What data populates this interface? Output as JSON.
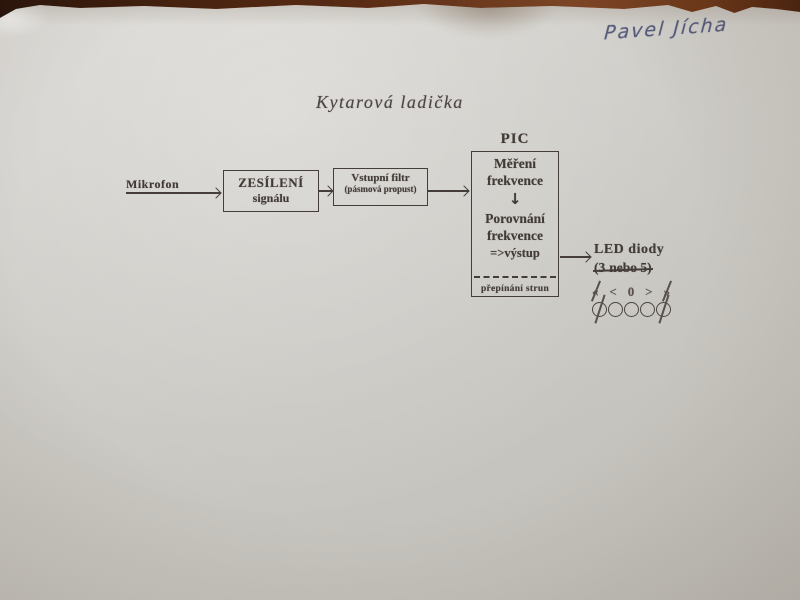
{
  "photo": {
    "handwritten_name": "Pavel Jícha"
  },
  "diagram": {
    "title": "Kytarová ladička",
    "microphone_label": "Mikrofon",
    "amplifier_box": {
      "line1": "ZESÍLENÍ",
      "line2": "signálu"
    },
    "filter_box": {
      "line1": "Vstupní filtr",
      "line2": "(pásmová propust)"
    },
    "pic": {
      "label": "PIC",
      "step1_line1": "Měření",
      "step1_line2": "frekvence",
      "down_arrow": "↓",
      "step2_line1": "Porovnání",
      "step2_line2": "frekvence",
      "step2_line3": "=>výstup",
      "footer": "přepínání strun"
    },
    "led": {
      "label": "LED diody",
      "count_prefix": "(3",
      "count_struck": "nebo 5)",
      "indicator_symbols": [
        "«",
        "<",
        "0",
        ">",
        "»"
      ],
      "led_count": 5,
      "crossed_out": [
        true,
        false,
        false,
        false,
        true
      ]
    },
    "colors": {
      "ink": "#413a36",
      "hand_ink": "#57504b",
      "pen_blue": "#575c7d",
      "paper": "#cbc9c3",
      "table_brown": "#5a2c15"
    }
  }
}
